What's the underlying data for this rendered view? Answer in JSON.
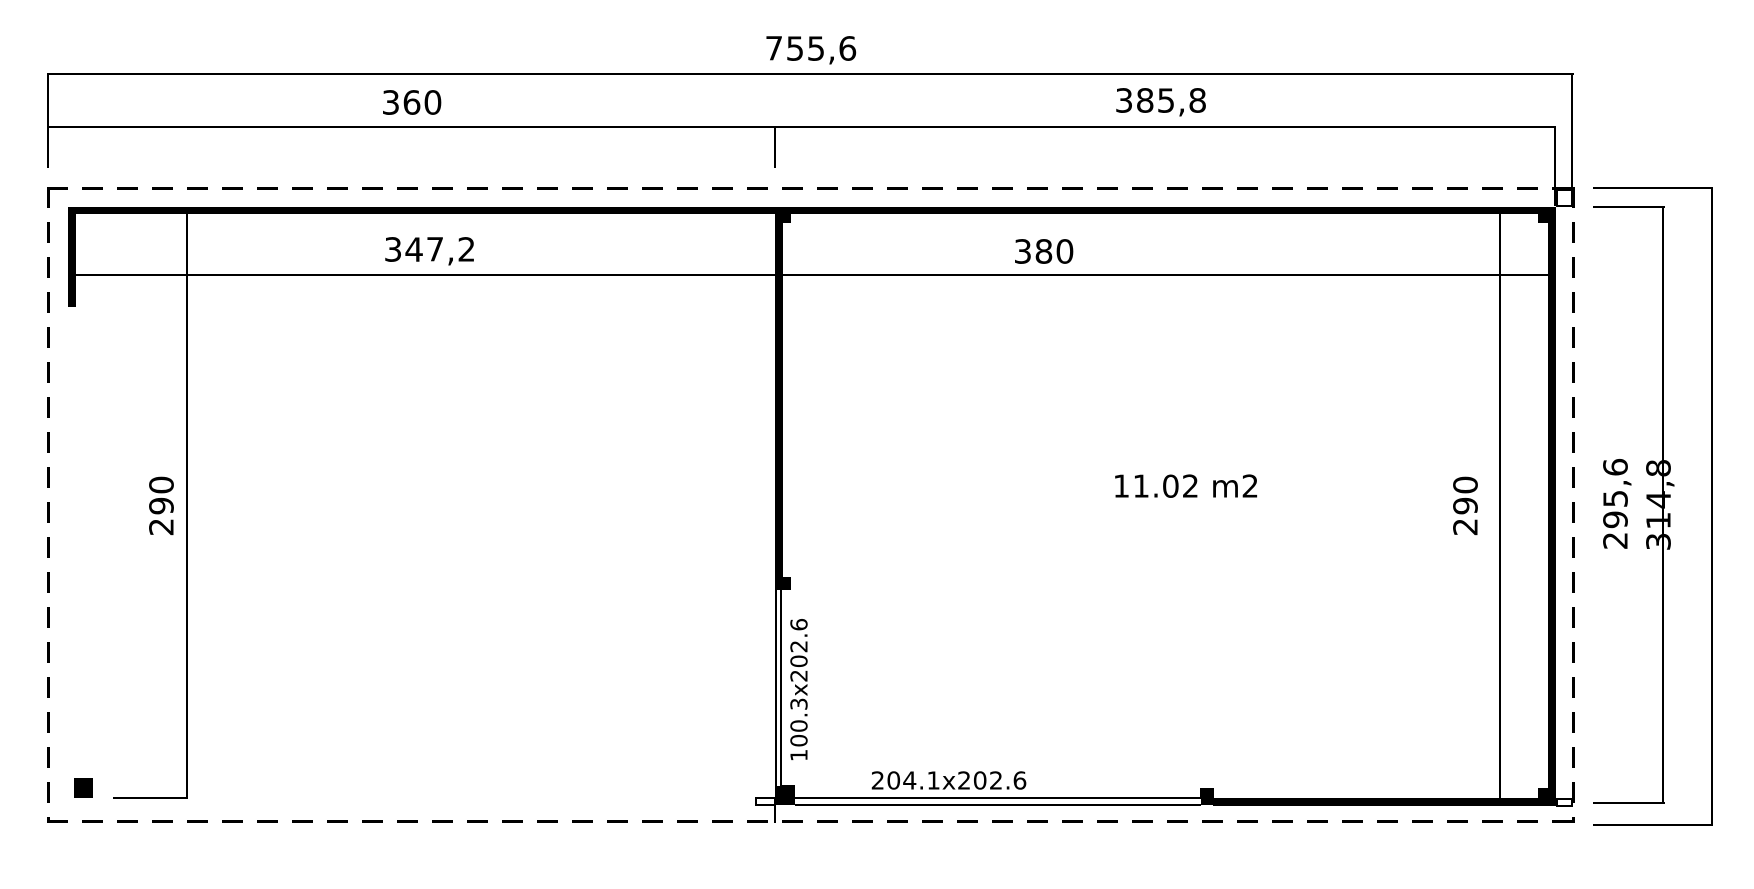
{
  "drawing": {
    "type": "floor-plan",
    "background_color": "#ffffff",
    "line_color": "#000000"
  },
  "dimensions_top": {
    "overall_width": "755,6",
    "left_bay_width": "360",
    "right_bay_width": "385,8"
  },
  "dimensions_inner": {
    "left_inner_width": "347,2",
    "right_inner_width": "380"
  },
  "dimensions_vertical": {
    "left_inner_depth": "290",
    "right_inner_depth": "290",
    "outer_depth": "295,6",
    "overall_depth": "314,8"
  },
  "room": {
    "area_label": "11.02 m2"
  },
  "openings": {
    "side_door_size": "100.3x202.6",
    "front_door_size": "204.1x202.6"
  }
}
